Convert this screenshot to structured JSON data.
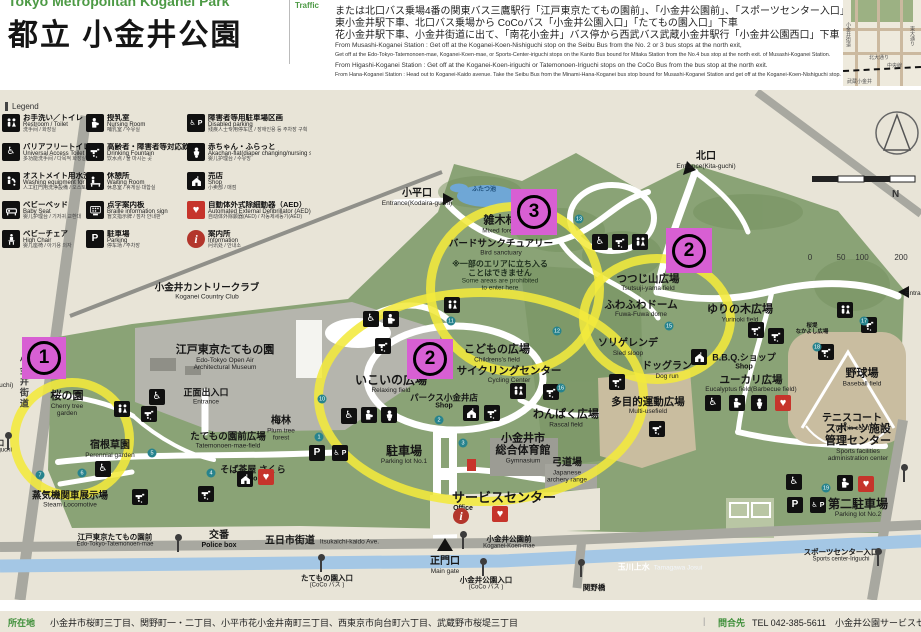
{
  "header": {
    "pretitle": "Tokyo Metropolitan Koganei Park",
    "title": "都立 小金井公園",
    "traffic_label": "Traffic",
    "jp_lines": [
      "または北口バス乗場4番の関東バス三鷹駅行「江戸東京たてもの園前」、「小金井公園前」、「スポーツセンター入口」下車",
      "東小金井駅下車、北口バス乗場から CoCoバス「小金井公園入口」「たてもの園入口」下車",
      "花小金井駅下車、小金井街道に出て、「南花小金井」バス停から西武バス武蔵小金井駅行「小金井公園西口」下車"
    ],
    "en_lines": [
      "From Musashi-Koganei Station : Get off at the Koganei-Koen-Nishiguchi stop on the Seibu Bus from the No. 2 or 3 bus stops at the north exit,",
      "Get off at the Edo-Tokyo-Tatemonoen-mae, Koganei-Koen-mae, or Sports-Center-iriguchi stops on the Kanto Bus bound for Mitaka Station from the No.4 bus stop at the north exit. of Musashi-Koganei Station.",
      "From Higashi-Koganei Station : Get off at the Koganei-Koen-iriguchi or Tatemonoen-Iriguchi stops on the CoCo Bus from the bus stop at the north exit.",
      "From Hana-Koganei Station : Head out to Koganei-Kaido avenue. Take the Seibu Bus from the Minami-Hana-Koganei bus stop bound for Musashi-Koganei Station and get off at the Koganei-Koen-Nishiguchi stop."
    ]
  },
  "inset": {
    "kita_odori": "北大通り",
    "chuo_line": "中央線",
    "musashi_koganei": "武蔵小金井",
    "koganei_kaido": "小金井街道",
    "higashi_odori": "東大通り"
  },
  "legend": {
    "title": "Legend",
    "items": [
      {
        "icon": "toilet",
        "jp": "お手洗い／トイレ",
        "en": "Restroom / Toilet",
        "sub": "洗手间 / 화장실"
      },
      {
        "icon": "accessible",
        "jp": "バリアフリートイレ",
        "en": "Universal Access Toilet",
        "sub": "多功能洗手间 / 다목적 화장실"
      },
      {
        "icon": "ostomate",
        "jp": "オストメイト用水洗器具など",
        "en": "Washing equipment for Ostomate",
        "sub": "人工肛門用洗浄設備 / 오스토메이트용 수세기구 등"
      },
      {
        "icon": "baby-bed",
        "jp": "ベビーベッド",
        "en": "Baby Seat",
        "sub": "婴儿护理台 / 기저귀 교환대"
      },
      {
        "icon": "high-chair",
        "jp": "ベビーチェア",
        "en": "High Chair",
        "sub": "婴儿座椅 / 아기용 의자"
      },
      {
        "icon": "nursing",
        "jp": "授乳室",
        "en": "Nursing Room",
        "sub": "哺乳室 / 수유실"
      },
      {
        "icon": "fountain",
        "jp": "高齢者・障害者等対応飲用水栓",
        "en": "Drinking Fountain",
        "sub": "饮水点 / 물 마시는 곳"
      },
      {
        "icon": "waiting",
        "jp": "休憩所",
        "en": "Waiting Room",
        "sub": "休息室 / 휴게실·대합실"
      },
      {
        "icon": "braille",
        "jp": "点字案内板",
        "en": "Braille information sign",
        "sub": "盲文指示牌 / 점자 안내판"
      },
      {
        "icon": "parking",
        "jp": "駐車場",
        "en": "Parking",
        "sub": "停车场 / 주차장"
      },
      {
        "icon": "disabled-parking",
        "jp": "障害者等用駐車場区画",
        "en": "Disabled parking",
        "sub": "残疾人士专用停车区 / 장애인용 등 주차장 구획"
      },
      {
        "icon": "baby",
        "jp": "赤ちゃん・ふらっと",
        "en": "Akachan-flat(diaper changing/nursing station)",
        "sub": "婴儿护理台 / 수유방"
      },
      {
        "icon": "shop",
        "jp": "売店",
        "en": "Shop",
        "sub": "小卖部 / 매점"
      },
      {
        "icon": "aed",
        "jp": "自動体外式除細動器（AED）",
        "en": "Automated External Defibrillator (AED)",
        "sub": "自动体外除颤器(AED) / 자동제세동기(AED)"
      },
      {
        "icon": "info",
        "jp": "案内所",
        "en": "Information",
        "sub": "问讯处 / 안내소"
      }
    ]
  },
  "compass": "N",
  "scale_ticks": [
    "0",
    "50",
    "100",
    "200"
  ],
  "map": {
    "labels": [
      {
        "id": "country-club",
        "x": 207,
        "y": 292,
        "jp": "小金井カントリークラブ",
        "en": "Koganei Country Club",
        "s": 9.5
      },
      {
        "id": "edo-museum",
        "x": 225,
        "y": 358,
        "jp": "江戸東京たてもの園",
        "en": "Edo-Tokyo Open Air",
        "en2": "Architectural Museum",
        "s": 11
      },
      {
        "id": "main-entrance",
        "x": 206,
        "y": 397,
        "jp": "正面出入口",
        "en": "Entrance",
        "s": 9
      },
      {
        "id": "cherry-garden",
        "x": 67,
        "y": 404,
        "jp": "桜の園",
        "en": "Cherry tree",
        "en2": "garden",
        "s": 11
      },
      {
        "id": "perennial-garden",
        "x": 110,
        "y": 450,
        "jp": "宿根草園",
        "en": "Perennial garden",
        "s": 10
      },
      {
        "id": "steam-locomotive",
        "x": 70,
        "y": 500,
        "jp": "蒸気機関車展示場",
        "en": "Steam Locomotive",
        "s": 9.5
      },
      {
        "id": "tatemonoen-mae-field",
        "x": 228,
        "y": 441,
        "jp": "たてもの園前広場",
        "en": "Tatemonoen-mae-field",
        "s": 9.5
      },
      {
        "id": "plum-forest",
        "x": 281,
        "y": 429,
        "jp": "梅林",
        "en": "Plum tree",
        "en2": "forest",
        "s": 10
      },
      {
        "id": "soba-chaya",
        "x": 253,
        "y": 474,
        "jp": "そば茶屋 さくら",
        "en": "Shop",
        "s": 9,
        "cls": "shoplb"
      },
      {
        "id": "police-box",
        "x": 219,
        "y": 540,
        "jp": "交番",
        "en": "Police box",
        "s": 10,
        "cls": "shoplb"
      },
      {
        "id": "itsukaichi-kaido",
        "x": 322,
        "y": 542,
        "jp": "五日市街道",
        "en": "Itsukaichi-kaido Ave.",
        "cls": "roadlb"
      },
      {
        "id": "tatemonoen-mae-stop",
        "x": 115,
        "y": 541,
        "jp": "江戸東京たてもの園前",
        "en": "Edo-Tokyo-Tatemonoen-mae",
        "cls": "stop"
      },
      {
        "id": "relaxing-field",
        "x": 391,
        "y": 384,
        "jp": "いこいの広場",
        "en": "Relaxing field",
        "s": 12
      },
      {
        "id": "parks-koganei",
        "x": 444,
        "y": 402,
        "jp": "パークス小金井店",
        "en": "Shop",
        "s": 8.5,
        "cls": "shoplb"
      },
      {
        "id": "parking1",
        "x": 404,
        "y": 455,
        "jp": "駐車場",
        "en": "Parking lot No.1",
        "s": 12
      },
      {
        "id": "childrens-field",
        "x": 497,
        "y": 354,
        "jp": "こどもの広場",
        "en": "Childrens's field",
        "s": 11
      },
      {
        "id": "cycling-center",
        "x": 509,
        "y": 375,
        "jp": "サイクリングセンター",
        "en": "Cycling Center",
        "s": 10.5
      },
      {
        "id": "rascal-field",
        "x": 566,
        "y": 419,
        "jp": "わんぱく広場",
        "en": "Rascal field",
        "s": 11
      },
      {
        "id": "gymnasium",
        "x": 523,
        "y": 449,
        "jp": "小金井市",
        "jp2": "総合体育館",
        "en": "Gymnasium",
        "s": 11
      },
      {
        "id": "archery-range",
        "x": 567,
        "y": 471,
        "jp": "弓道場",
        "en": "Japanese",
        "en2": "archery range",
        "s": 10
      },
      {
        "id": "service-center",
        "x": 504,
        "y": 498,
        "jp": "サービスセンター",
        "s": 13
      },
      {
        "id": "office",
        "x": 463,
        "y": 509,
        "en": "Office",
        "cls": "boldEn"
      },
      {
        "id": "main-gate",
        "x": 445,
        "y": 566,
        "jp": "正門口",
        "en": "Main gate",
        "s": 10
      },
      {
        "id": "koganei-koen-mae-stop",
        "x": 509,
        "y": 543,
        "jp": "小金井公園前",
        "en": "Koganei-Koen-mae",
        "cls": "stop"
      },
      {
        "id": "koganei-koen-iriguchi-stop",
        "x": 486,
        "y": 584,
        "jp": "小金井公園入口",
        "en": "(CoCo バス )",
        "cls": "stop"
      },
      {
        "id": "tatemonoen-iriguchi-stop",
        "x": 327,
        "y": 582,
        "jp": "たてもの園入口",
        "en": "(CoCo バス )",
        "cls": "stop"
      },
      {
        "id": "sekino-bashi",
        "x": 594,
        "y": 588,
        "jp": "関野橋",
        "cls": "stop"
      },
      {
        "id": "mixed-forest",
        "x": 500,
        "y": 225,
        "jp": "雑木林",
        "en": "Mixed forest",
        "s": 11
      },
      {
        "id": "bird-sanctuary",
        "x": 501,
        "y": 248,
        "jp": "バードサンクチュアリー",
        "en": "Bird sanctuary",
        "s": 9.5
      },
      {
        "id": "notice",
        "x": 500,
        "y": 276,
        "jp": "※一部のエリアに立ち入る",
        "jp2": "ことはできません",
        "en": "Some areas are prohibited",
        "en2": "to enter here",
        "cls": "notice"
      },
      {
        "id": "futatsu-ike",
        "x": 484,
        "y": 190,
        "jp": "ふたつ池",
        "cls": "pond"
      },
      {
        "id": "kodaira-guchi",
        "x": 417,
        "y": 198,
        "jp": "小平口",
        "en": "Entrance(Kodaira-guchi)",
        "s": 10,
        "cls": "gate"
      },
      {
        "id": "kita-guchi",
        "x": 706,
        "y": 161,
        "jp": "北口",
        "en": "Entrance(Kita-guchi)",
        "s": 10,
        "cls": "gate"
      },
      {
        "id": "tsutsuji-yama",
        "x": 648,
        "y": 283,
        "jp": "つつじ山広場",
        "en": "Tsutsuji-yama field",
        "s": 10.5
      },
      {
        "id": "fuwafuwa-dome",
        "x": 641,
        "y": 309,
        "jp": "ふわふわドーム",
        "en": "Fuwa-Fuwa dome",
        "s": 10.5
      },
      {
        "id": "yurinoki-field",
        "x": 740,
        "y": 314,
        "jp": "ゆりの木広場",
        "en": "Yurinoki field",
        "s": 11
      },
      {
        "id": "sled-slope",
        "x": 628,
        "y": 348,
        "jp": "ソリゲレンデ",
        "en": "Sled sloop",
        "s": 10
      },
      {
        "id": "dog-run",
        "x": 667,
        "y": 371,
        "jp": "ドッグラン",
        "en": "Dog run",
        "s": 10
      },
      {
        "id": "multi-use-field",
        "x": 648,
        "y": 406,
        "jp": "多目的運動広場",
        "en": "Multi-usefield",
        "s": 10.5
      },
      {
        "id": "bbq-shop",
        "x": 744,
        "y": 362,
        "jp": "B.B.Q.ショップ",
        "en": "Shop",
        "s": 9,
        "cls": "shoplb"
      },
      {
        "id": "eucalyptus-field",
        "x": 751,
        "y": 384,
        "jp": "ユーカリ広場",
        "en": "Eucalyptus field(Barbecue field)",
        "s": 10.5
      },
      {
        "id": "baseball-field",
        "x": 862,
        "y": 378,
        "jp": "野球場",
        "en": "Baseball field",
        "s": 11
      },
      {
        "id": "tennis-court",
        "x": 852,
        "y": 423,
        "jp": "テニスコート",
        "en": "Tennis court",
        "s": 10
      },
      {
        "id": "sports-admin",
        "x": 858,
        "y": 443,
        "jp": "スポーツ施設",
        "jp2": "管理センター",
        "en": "Sports facilities",
        "en2": "administration center",
        "s": 11
      },
      {
        "id": "parking2",
        "x": 858,
        "y": 508,
        "jp": "第二駐車場",
        "en": "Parking lot No.2",
        "s": 12
      },
      {
        "id": "sports-center-iriguchi-stop",
        "x": 841,
        "y": 556,
        "jp": "スポーツセンター入口",
        "en": "Sports center-Iriguchi",
        "cls": "stop"
      },
      {
        "id": "tamagawa-josui",
        "x": 660,
        "y": 568,
        "jp": "玉川上水",
        "en": "Tamagawa Josui",
        "cls": "waterlb"
      },
      {
        "id": "nakayoshi-field",
        "x": 812,
        "y": 330,
        "jp": "桜堤",
        "jp2": "なかよし広場",
        "cls": "tiny"
      },
      {
        "id": "higashi-guchi",
        "x": 940,
        "y": 288,
        "jp": "東口",
        "en": "Entrance(Higashi-guchi)",
        "s": 10,
        "cls": "gate"
      },
      {
        "id": "nishi-guchi",
        "x": -18,
        "y": 380,
        "jp": "西口",
        "en": "Entrance(Nishi-guchi)",
        "s": 10,
        "cls": "gate"
      },
      {
        "id": "nishiguchi-stop",
        "x": -22,
        "y": 447,
        "jp": "小金井公園西口",
        "en": "Koganei-Koen-Nishiguchi",
        "cls": "stop"
      },
      {
        "id": "koganei-kaido-road",
        "x": 23,
        "y": 382,
        "jp": "小金井街道",
        "cls": "vroad"
      }
    ],
    "badges": [
      {
        "n": "1",
        "x": 22,
        "y": 337,
        "w": 44,
        "h": 42
      },
      {
        "n": "2",
        "x": 407,
        "y": 339,
        "w": 46,
        "h": 40
      },
      {
        "n": "3",
        "x": 511,
        "y": 189,
        "w": 46,
        "h": 46
      },
      {
        "n": "2",
        "x": 666,
        "y": 228,
        "w": 46,
        "h": 45
      }
    ],
    "circles": [
      {
        "x": 10,
        "y": 378,
        "w": 106,
        "h": 104
      },
      {
        "x": 314,
        "y": 288,
        "w": 316,
        "h": 200
      },
      {
        "x": 426,
        "y": 202,
        "w": 160,
        "h": 156
      },
      {
        "x": 579,
        "y": 254,
        "w": 138,
        "h": 112
      }
    ],
    "icons": [
      {
        "t": "accessible",
        "x": 157,
        "y": 397
      },
      {
        "t": "fountain",
        "x": 149,
        "y": 414
      },
      {
        "t": "toilet",
        "x": 122,
        "y": 409
      },
      {
        "t": "accessible",
        "x": 103,
        "y": 469
      },
      {
        "t": "fountain",
        "x": 140,
        "y": 497
      },
      {
        "t": "shop",
        "x": 245,
        "y": 479
      },
      {
        "t": "aed",
        "x": 266,
        "y": 477
      },
      {
        "t": "fountain",
        "x": 206,
        "y": 494
      },
      {
        "t": "parking",
        "x": 317,
        "y": 453
      },
      {
        "t": "disabled-parking",
        "x": 340,
        "y": 453
      },
      {
        "t": "accessible",
        "x": 371,
        "y": 319
      },
      {
        "t": "nursing",
        "x": 391,
        "y": 319
      },
      {
        "t": "fountain",
        "x": 383,
        "y": 346
      },
      {
        "t": "accessible",
        "x": 349,
        "y": 416
      },
      {
        "t": "nursing",
        "x": 369,
        "y": 415
      },
      {
        "t": "baby",
        "x": 389,
        "y": 415
      },
      {
        "t": "shop",
        "x": 471,
        "y": 413
      },
      {
        "t": "fountain",
        "x": 492,
        "y": 413
      },
      {
        "t": "toilet",
        "x": 518,
        "y": 391
      },
      {
        "t": "fountain",
        "x": 551,
        "y": 392
      },
      {
        "t": "fountain",
        "x": 617,
        "y": 382
      },
      {
        "t": "fountain",
        "x": 657,
        "y": 429
      },
      {
        "t": "accessible",
        "x": 600,
        "y": 242
      },
      {
        "t": "fountain",
        "x": 620,
        "y": 242
      },
      {
        "t": "toilet",
        "x": 640,
        "y": 242
      },
      {
        "t": "toilet",
        "x": 452,
        "y": 305
      },
      {
        "t": "fountain",
        "x": 756,
        "y": 330
      },
      {
        "t": "fountain",
        "x": 776,
        "y": 336
      },
      {
        "t": "toilet",
        "x": 845,
        "y": 310
      },
      {
        "t": "fountain",
        "x": 869,
        "y": 325
      },
      {
        "t": "fountain",
        "x": 826,
        "y": 352
      },
      {
        "t": "shop",
        "x": 699,
        "y": 357
      },
      {
        "t": "accessible",
        "x": 713,
        "y": 403
      },
      {
        "t": "nursing",
        "x": 737,
        "y": 403
      },
      {
        "t": "baby",
        "x": 759,
        "y": 403
      },
      {
        "t": "aed",
        "x": 783,
        "y": 403
      },
      {
        "t": "info",
        "x": 461,
        "y": 516
      },
      {
        "t": "aed",
        "x": 500,
        "y": 514
      },
      {
        "t": "accessible",
        "x": 794,
        "y": 482
      },
      {
        "t": "nursing",
        "x": 845,
        "y": 483
      },
      {
        "t": "aed",
        "x": 866,
        "y": 484
      },
      {
        "t": "parking",
        "x": 795,
        "y": 505
      },
      {
        "t": "disabled-parking",
        "x": 818,
        "y": 505
      }
    ],
    "stops": [
      {
        "x": 178,
        "y": 540
      },
      {
        "x": 321,
        "y": 560
      },
      {
        "x": 463,
        "y": 537
      },
      {
        "x": 483,
        "y": 564
      },
      {
        "x": 581,
        "y": 565
      },
      {
        "x": 878,
        "y": 554
      },
      {
        "x": 904,
        "y": 470
      },
      {
        "x": 8,
        "y": 438
      }
    ],
    "keynums": [
      {
        "n": "7",
        "x": 40,
        "y": 475
      },
      {
        "n": "6",
        "x": 82,
        "y": 473
      },
      {
        "n": "5",
        "x": 152,
        "y": 453
      },
      {
        "n": "4",
        "x": 211,
        "y": 473
      },
      {
        "n": "10",
        "x": 322,
        "y": 399
      },
      {
        "n": "1",
        "x": 319,
        "y": 437
      },
      {
        "n": "11",
        "x": 451,
        "y": 321
      },
      {
        "n": "13",
        "x": 579,
        "y": 219
      },
      {
        "n": "12",
        "x": 557,
        "y": 331
      },
      {
        "n": "15",
        "x": 669,
        "y": 326
      },
      {
        "n": "16",
        "x": 561,
        "y": 388
      },
      {
        "n": "17",
        "x": 864,
        "y": 321
      },
      {
        "n": "18",
        "x": 817,
        "y": 347
      },
      {
        "n": "19",
        "x": 826,
        "y": 488
      },
      {
        "n": "2",
        "x": 439,
        "y": 420
      },
      {
        "n": "3",
        "x": 463,
        "y": 443
      }
    ]
  },
  "footer": {
    "loc_label": "所在地",
    "loc_text": "小金井市桜町三丁目、関野町一・二丁目、小平市花小金井南町三丁目、西東京市向台町六丁目、武蔵野市桜堤三丁目",
    "divider": "|",
    "contact_label": "問合先",
    "contact_text": "TEL 042-385-5611　小金井公園サービスセンター"
  },
  "colors": {
    "magenta": "#d85fd3",
    "highlight_yellow": "#f2e93c",
    "park_green": "#8aa376",
    "water_blue": "#a4c7e5",
    "header_green": "#4d9a45"
  }
}
